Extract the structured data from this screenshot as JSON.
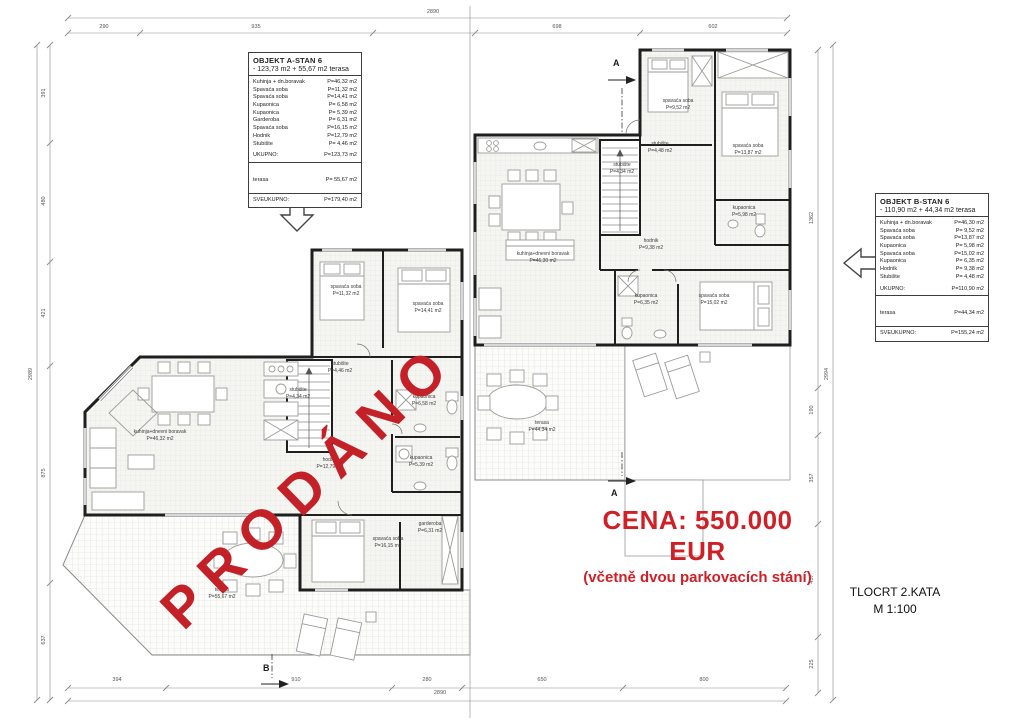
{
  "stamp": {
    "text": "PRODÁNO",
    "color": "#c32127"
  },
  "price": {
    "line1": "CENA: 550.000 EUR",
    "line2": "(včetně dvou parkovacích stání)",
    "color": "#ce2026"
  },
  "title_block": {
    "title": "TLOCRT 2.KATA",
    "scale": "M 1:100"
  },
  "unit_a": {
    "title": "OBJEKT A-STAN 6",
    "subtitle": "- 123,73 m2 + 55,67 m2 terasa",
    "rooms": [
      {
        "label": "Kuhinja + dn.boravak",
        "area": "P=46,32 m2"
      },
      {
        "label": "Spavaća soba",
        "area": "P=11,32 m2"
      },
      {
        "label": "Spavaća soba",
        "area": "P=14,41 m2"
      },
      {
        "label": "Kupaonica",
        "area": "P= 6,58 m2"
      },
      {
        "label": "Kupaonica",
        "area": "P= 5,39 m2"
      },
      {
        "label": "Garderoba",
        "area": "P= 6,31 m2"
      },
      {
        "label": "Spavaća soba",
        "area": "P=16,15 m2"
      },
      {
        "label": "Hodnik",
        "area": "P=12,79 m2"
      },
      {
        "label": "Stubište",
        "area": "P= 4,46 m2"
      }
    ],
    "total_label": "UKUPNO:",
    "total_area": "P=123,73 m2",
    "terrace_label": "terasa",
    "terrace_area": "P= 55,67 m2",
    "grand_label": "SVEUKUPNO:",
    "grand_area": "P=179,40 m2"
  },
  "unit_b": {
    "title": "OBJEKT B-STAN 6",
    "subtitle": "- 110,90 m2 + 44,34 m2 terasa",
    "rooms": [
      {
        "label": "Kuhinja + dn.boravak",
        "area": "P=46,30 m2"
      },
      {
        "label": "Spavaća soba",
        "area": "P= 9,52 m2"
      },
      {
        "label": "Spavaća soba",
        "area": "P=13,87 m2"
      },
      {
        "label": "Kupaonica",
        "area": "P= 5,98 m2"
      },
      {
        "label": "Spavaća soba",
        "area": "P=15,02 m2"
      },
      {
        "label": "Kupaonica",
        "area": "P= 6,35 m2"
      },
      {
        "label": "Hodnik",
        "area": "P= 9,38 m2"
      },
      {
        "label": "Stubište",
        "area": "P= 4,48 m2"
      }
    ],
    "total_label": "UKUPNO:",
    "total_area": "P=110,90 m2",
    "terrace_label": "terasa",
    "terrace_area": "P=44,34 m2",
    "grand_label": "SVEUKUPNO:",
    "grand_area": "P=155,24 m2"
  },
  "plan_labels": [
    {
      "name": "spavaća soba",
      "area": "P=11,32 m2"
    },
    {
      "name": "spavaća soba",
      "area": "P=14,41 m2"
    },
    {
      "name": "stubište",
      "area": "P=4,46 m2"
    },
    {
      "name": "stubište",
      "area": "P=4,34 m2"
    },
    {
      "name": "hodnik",
      "area": "P=12,79 m2"
    },
    {
      "name": "kupaonica",
      "area": "P=6,58 m2"
    },
    {
      "name": "kupaonica",
      "area": "P=5,39 m2"
    },
    {
      "name": "kuhinja+dnevni boravak",
      "area": "P=46,32 m2"
    },
    {
      "name": "spavaća soba",
      "area": "P=16,15 m2"
    },
    {
      "name": "garderoba",
      "area": "P=6,31 m2"
    },
    {
      "name": "terasa",
      "area": "P=55,67 m2"
    },
    {
      "name": "spavaća soba",
      "area": "P=9,52 m2"
    },
    {
      "name": "spavaća soba",
      "area": "P=13,87 m2"
    },
    {
      "name": "stubište",
      "area": "P=4,48 m2"
    },
    {
      "name": "stubište",
      "area": "P=4,34 m2"
    },
    {
      "name": "kupaonica",
      "area": "P=5,98 m2"
    },
    {
      "name": "hodnik",
      "area": "P=9,38 m2"
    },
    {
      "name": "kupaonica",
      "area": "P=6,35 m2"
    },
    {
      "name": "spavaća soba",
      "area": "P=15,02 m2"
    },
    {
      "name": "kuhinja+dnevni boravak",
      "area": "P=46,30 m2"
    },
    {
      "name": "terasa",
      "area": "P=44,34 m2"
    }
  ],
  "dims": {
    "top_total": "2890",
    "top": [
      "290",
      "935",
      "698",
      "602"
    ],
    "bottom_total": "2890",
    "bottom": [
      "394",
      "910",
      "280",
      "650",
      "800"
    ],
    "left_total": "2989",
    "left": [
      "391",
      "480",
      "421",
      "875",
      "637"
    ],
    "right_total": "2994",
    "right": [
      "1362",
      "190",
      "357",
      "457",
      "225"
    ]
  },
  "markers": {
    "section_a": "A",
    "section_b": "B"
  }
}
